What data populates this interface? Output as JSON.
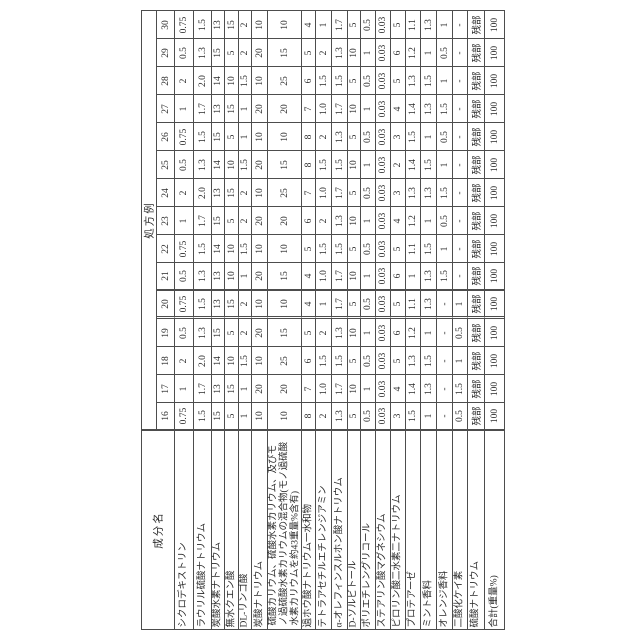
{
  "table": {
    "row_header_label": "処方例",
    "col_header_label": "成分名",
    "remainder_label": "残部",
    "components": [
      "シクロデキストリン",
      "ラウリル硫酸ナトリウム",
      "炭酸水素ナトリウム",
      "無水クエン酸",
      "DL-リンゴ酸",
      "炭酸ナトリウム",
      "硫酸カリウム、硫酸水素カリウム、及びモノ過硫酸水素カリウムの混合物(モノ過硫酸水素カリウムを約43重量%含有)",
      "過ホウ酸ナトリウム一水和物",
      "テトラアセチルエチレンジアミン",
      "α-オレフィンスルホン酸ナトリウム",
      "D-ソルビトール",
      "ポリエチレングリコール",
      "ステアリン酸マグネシウム",
      "ピロリン酸二水素二ナトリウム",
      "プロテアーゼ",
      "ミント香料",
      "オレンジ香料",
      "二酸化ケイ素",
      "硫酸ナトリウム",
      "合計(重量%)"
    ],
    "examples": [
      {
        "no": "30",
        "values": [
          "0.75",
          "1.5",
          "13",
          "15",
          "2",
          "10",
          "10",
          "4",
          "1",
          "1.7",
          "5",
          "0.5",
          "0.03",
          "5",
          "1.1",
          "1.3",
          "1",
          "-",
          "残部",
          "100"
        ]
      },
      {
        "no": "29",
        "values": [
          "0.5",
          "1.3",
          "15",
          "5",
          "2",
          "20",
          "15",
          "5",
          "2",
          "1.3",
          "10",
          "1",
          "0.03",
          "6",
          "1.2",
          "1",
          "0.5",
          "-",
          "残部",
          "100"
        ]
      },
      {
        "no": "28",
        "values": [
          "2",
          "2.0",
          "14",
          "10",
          "1.5",
          "10",
          "25",
          "6",
          "1.5",
          "1.5",
          "5",
          "0.5",
          "0.03",
          "5",
          "1.3",
          "1.5",
          "1",
          "-",
          "残部",
          "100"
        ]
      },
      {
        "no": "27",
        "values": [
          "1",
          "1.7",
          "13",
          "15",
          "1",
          "20",
          "20",
          "7",
          "1.0",
          "1.7",
          "10",
          "1",
          "0.03",
          "4",
          "1.4",
          "1.3",
          "1.5",
          "-",
          "残部",
          "100"
        ]
      },
      {
        "no": "26",
        "values": [
          "0.75",
          "1.5",
          "15",
          "5",
          "1",
          "10",
          "10",
          "8",
          "2",
          "1.3",
          "5",
          "0.5",
          "0.03",
          "3",
          "1.5",
          "1",
          "0.5",
          "-",
          "残部",
          "100"
        ]
      },
      {
        "no": "25",
        "values": [
          "0.5",
          "1.3",
          "14",
          "10",
          "1.5",
          "20",
          "15",
          "8",
          "1.5",
          "1.5",
          "10",
          "1",
          "0.03",
          "2",
          "1.4",
          "1.5",
          "1",
          "-",
          "残部",
          "100"
        ]
      },
      {
        "no": "24",
        "values": [
          "2",
          "2.0",
          "13",
          "15",
          "2",
          "10",
          "25",
          "7",
          "1.0",
          "1.7",
          "5",
          "0.5",
          "0.03",
          "3",
          "1.3",
          "1.3",
          "1.5",
          "-",
          "残部",
          "100"
        ]
      },
      {
        "no": "23",
        "values": [
          "1",
          "1.7",
          "15",
          "5",
          "2",
          "20",
          "20",
          "6",
          "2",
          "1.3",
          "10",
          "1",
          "0.03",
          "4",
          "1.2",
          "1",
          "0.5",
          "-",
          "残部",
          "100"
        ]
      },
      {
        "no": "22",
        "values": [
          "0.75",
          "1.5",
          "14",
          "10",
          "1.5",
          "10",
          "10",
          "5",
          "1.5",
          "1.5",
          "5",
          "0.5",
          "0.03",
          "5",
          "1.1",
          "1.5",
          "1",
          "-",
          "残部",
          "100"
        ]
      },
      {
        "no": "21",
        "values": [
          "0.5",
          "1.3",
          "13",
          "10",
          "1",
          "20",
          "15",
          "4",
          "1.0",
          "1.7",
          "10",
          "1",
          "0.03",
          "6",
          "1",
          "1.3",
          "1.5",
          "-",
          "残部",
          "100"
        ]
      },
      {
        "no": "20",
        "values": [
          "0.75",
          "1.5",
          "13",
          "15",
          "2",
          "10",
          "10",
          "4",
          "1",
          "1.7",
          "5",
          "0.5",
          "0.03",
          "5",
          "1.1",
          "1.3",
          "-",
          "1",
          "残部",
          "100"
        ]
      },
      {
        "no": "19",
        "values": [
          "0.5",
          "1.3",
          "15",
          "5",
          "2",
          "20",
          "15",
          "5",
          "2",
          "1.3",
          "10",
          "1",
          "0.03",
          "6",
          "1.2",
          "1",
          "-",
          "0.5",
          "残部",
          "100"
        ]
      },
      {
        "no": "18",
        "values": [
          "2",
          "2.0",
          "14",
          "10",
          "1.5",
          "10",
          "25",
          "6",
          "1.5",
          "1.5",
          "5",
          "0.5",
          "0.03",
          "5",
          "1.3",
          "1.5",
          "-",
          "1",
          "残部",
          "100"
        ]
      },
      {
        "no": "17",
        "values": [
          "1",
          "1.7",
          "13",
          "15",
          "1",
          "20",
          "20",
          "7",
          "1.0",
          "1.7",
          "10",
          "1",
          "0.03",
          "4",
          "1.4",
          "1.3",
          "-",
          "1.5",
          "残部",
          "100"
        ]
      },
      {
        "no": "16",
        "values": [
          "0.75",
          "1.5",
          "15",
          "5",
          "1",
          "10",
          "10",
          "8",
          "2",
          "1.3",
          "5",
          "0.5",
          "0.03",
          "3",
          "1.5",
          "1",
          "-",
          "0.5",
          "残部",
          "100"
        ]
      }
    ]
  }
}
